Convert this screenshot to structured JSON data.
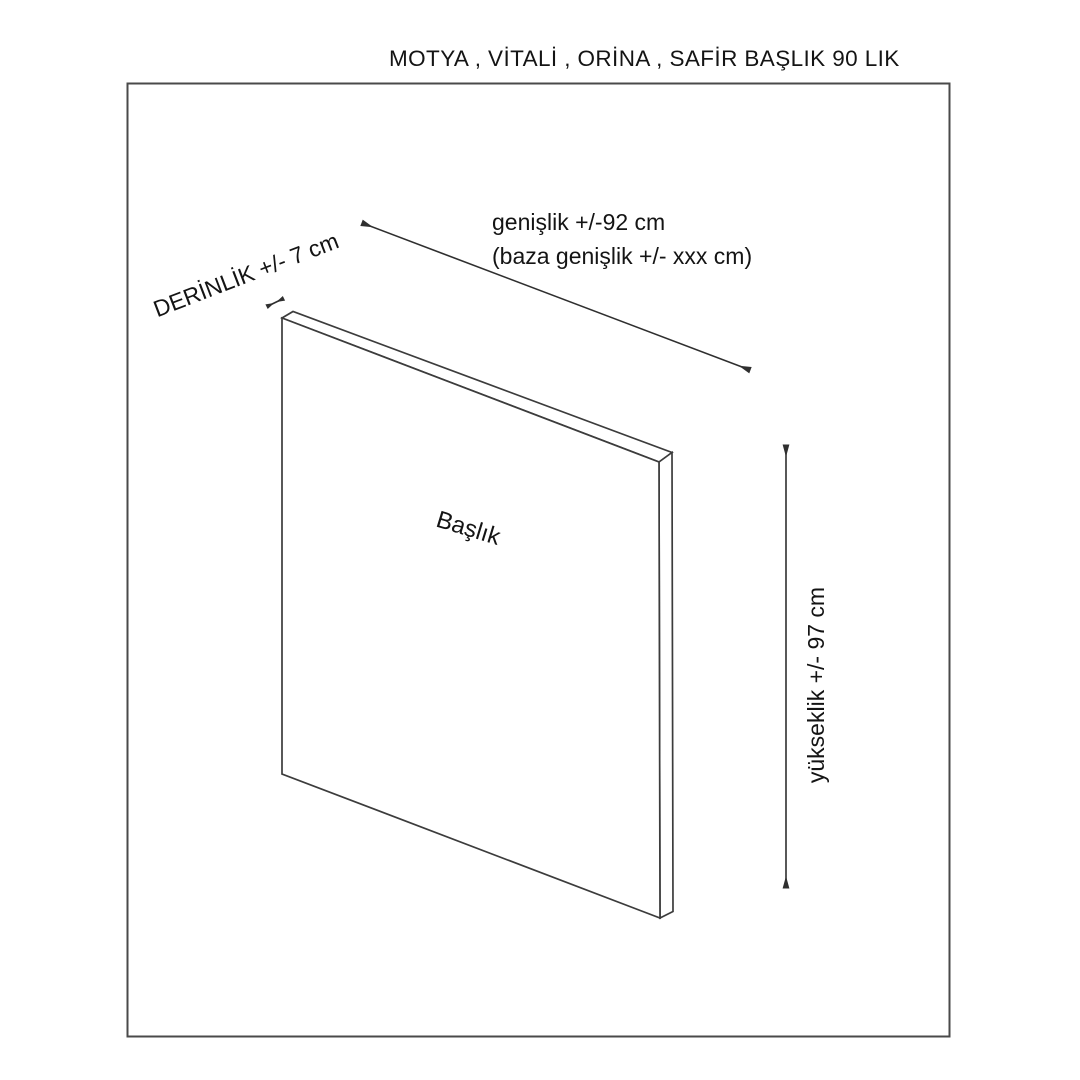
{
  "page": {
    "title": "MOTYA , VİTALİ , ORİNA , SAFİR BAŞLIK 90 LIK"
  },
  "diagram": {
    "part_label": "Başlık",
    "dimensions": {
      "width_line1": "genişlik +/-92 cm",
      "width_line2": "(baza genişlik +/- xxx cm)",
      "depth": "DERİNLİK +/- 7 cm",
      "height": "yükseklik +/- 97 cm"
    }
  },
  "colors": {
    "line": "#3c3c3c",
    "border": "#4a4a4a",
    "arrow": "#2f2f2f",
    "text": "#141414",
    "background": "#ffffff"
  }
}
